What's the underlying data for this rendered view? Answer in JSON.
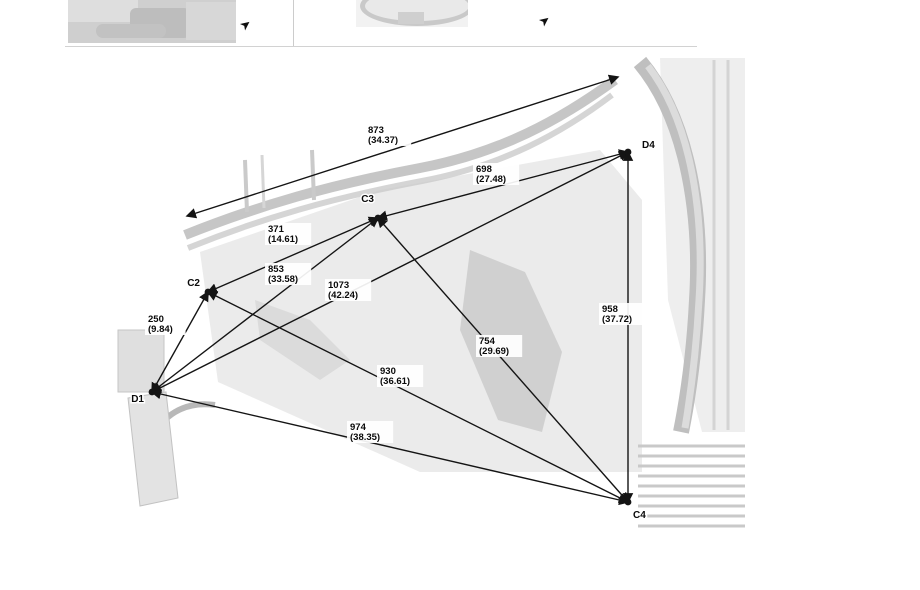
{
  "header_row": {
    "left_cell": {
      "image_alt": "body-structure-photo",
      "arrow_icon": "➤"
    },
    "right_cell": {
      "image_alt": "underbody-view-photo",
      "arrow_icon": "➤"
    }
  },
  "diagram": {
    "title_hint": "body dimension measurement diagram",
    "line_color": "#141414",
    "label_text_color": "#0a0a0a",
    "points": [
      {
        "id": "C2",
        "x": 208,
        "y": 292,
        "lx": 200,
        "ly": 286,
        "anchor": "end"
      },
      {
        "id": "C3",
        "x": 378,
        "y": 218,
        "lx": 374,
        "ly": 202,
        "anchor": "end"
      },
      {
        "id": "D1",
        "x": 152,
        "y": 392,
        "lx": 144,
        "ly": 402,
        "anchor": "end"
      },
      {
        "id": "D4",
        "x": 628,
        "y": 152,
        "lx": 642,
        "ly": 148,
        "anchor": "start"
      },
      {
        "id": "C4",
        "x": 628,
        "y": 502,
        "lx": 633,
        "ly": 518,
        "anchor": "start"
      }
    ],
    "measurements": [
      {
        "mm": "873",
        "inches": "(34.37)",
        "x1": 187,
        "y1": 216,
        "x2": 618,
        "y2": 77,
        "lx": 368,
        "ly": 133
      },
      {
        "mm": "698",
        "inches": "(27.48)",
        "x1": 378,
        "y1": 218,
        "x2": 628,
        "y2": 152,
        "lx": 476,
        "ly": 172
      },
      {
        "mm": "371",
        "inches": "(14.61)",
        "x1": 208,
        "y1": 292,
        "x2": 378,
        "y2": 218,
        "lx": 268,
        "ly": 232
      },
      {
        "mm": "853",
        "inches": "(33.58)",
        "x1": 152,
        "y1": 392,
        "x2": 378,
        "y2": 218,
        "lx": 268,
        "ly": 272
      },
      {
        "mm": "1073",
        "inches": "(42.24)",
        "x1": 152,
        "y1": 392,
        "x2": 628,
        "y2": 152,
        "lx": 328,
        "ly": 288
      },
      {
        "mm": "250",
        "inches": "(9.84)",
        "x1": 208,
        "y1": 292,
        "x2": 152,
        "y2": 392,
        "lx": 148,
        "ly": 322
      },
      {
        "mm": "754",
        "inches": "(29.69)",
        "x1": 378,
        "y1": 218,
        "x2": 628,
        "y2": 502,
        "lx": 479,
        "ly": 344
      },
      {
        "mm": "930",
        "inches": "(36.61)",
        "x1": 208,
        "y1": 292,
        "x2": 628,
        "y2": 502,
        "lx": 380,
        "ly": 374
      },
      {
        "mm": "974",
        "inches": "(38.35)",
        "x1": 152,
        "y1": 392,
        "x2": 628,
        "y2": 502,
        "lx": 350,
        "ly": 430
      },
      {
        "mm": "958",
        "inches": "(37.72)",
        "x1": 628,
        "y1": 152,
        "x2": 628,
        "y2": 502,
        "lx": 602,
        "ly": 312
      }
    ]
  }
}
